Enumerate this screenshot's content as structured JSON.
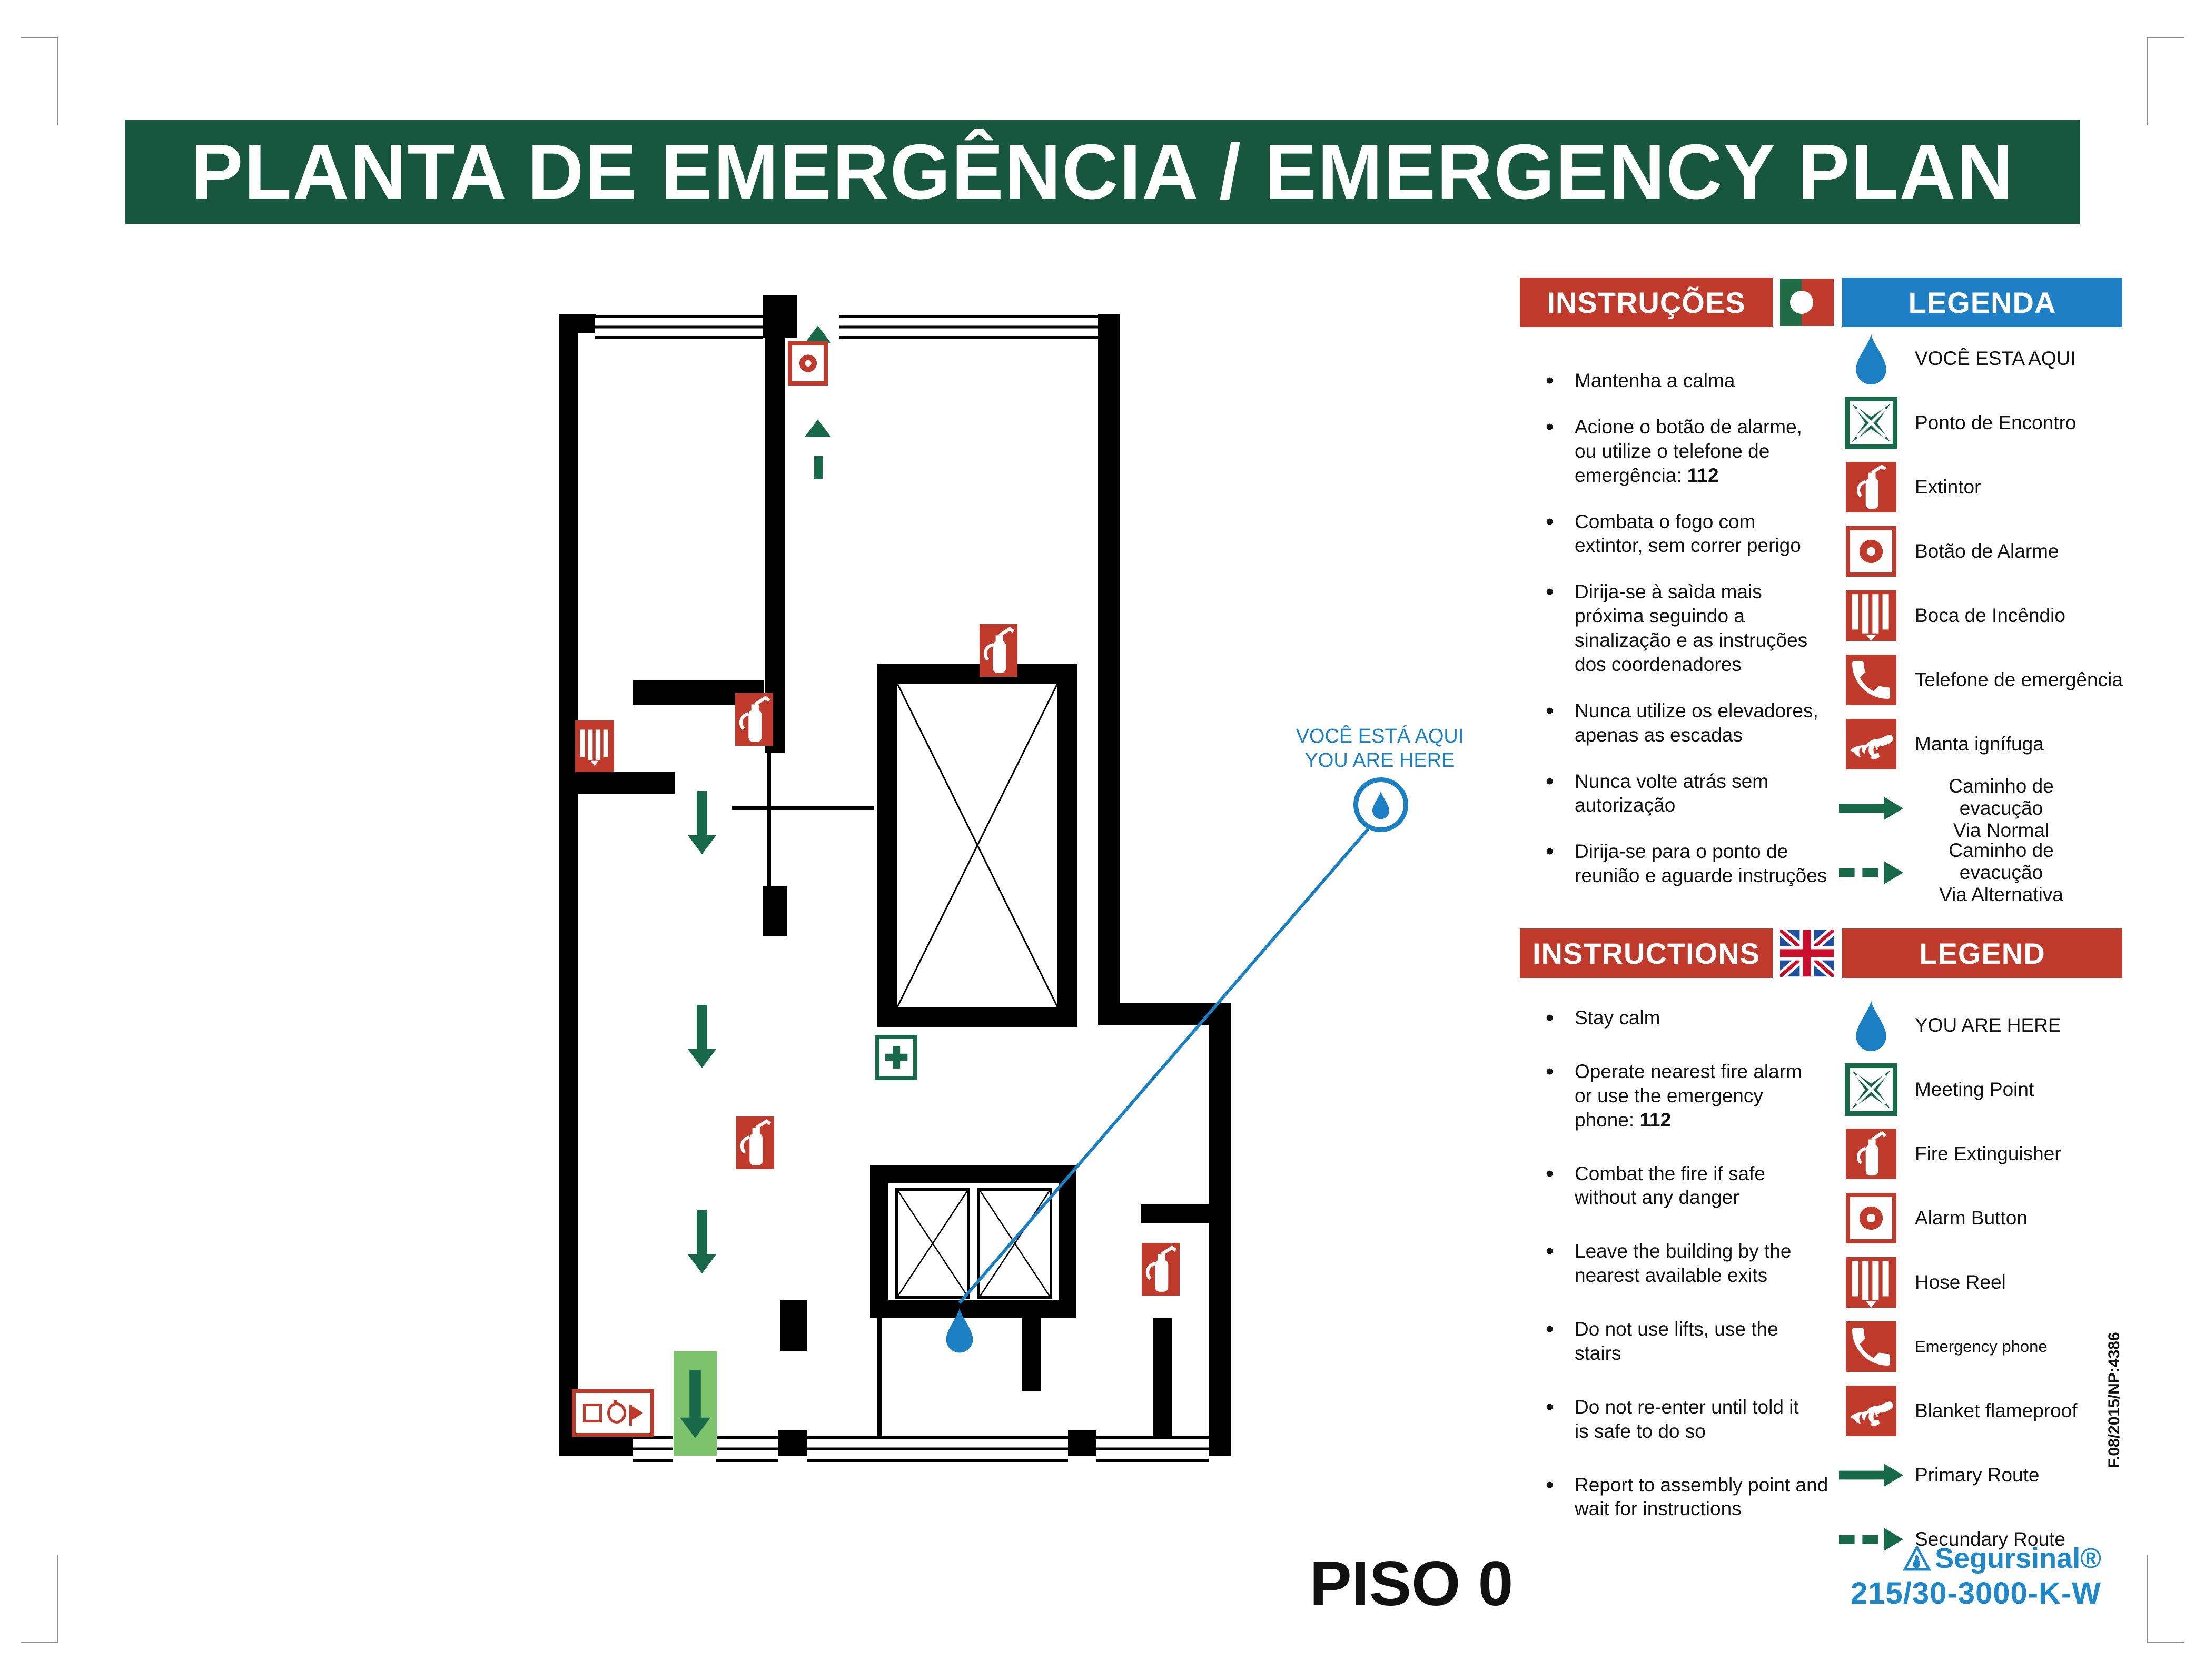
{
  "title": "PLANTA DE EMERGÊNCIA / EMERGENCY PLAN",
  "floor_label": "PISO 0",
  "callout": {
    "line1": "VOCÊ ESTÁ AQUI",
    "line2": "YOU ARE HERE"
  },
  "pt": {
    "instructions_header": "INSTRUÇÕES",
    "legend_header": "LEGENDA",
    "instructions": [
      "Mantenha a calma",
      "Acione o botão de alarme,\nou utilize o telefone de\nemergência: 112",
      "Combata o fogo com\nextintor, sem correr perigo",
      "Dirija-se à saìda mais\npróxima seguindo a\nsinalização e as instruções\ndos coordenadores",
      "Nunca utilize os elevadores,\napenas as escadas",
      "Nunca volte atrás sem\nautorização",
      "Dirija-se para o ponto de\nreunião e aguarde instruções"
    ],
    "legend": [
      {
        "icon": "you-are-here-drop-icon",
        "label": "VOCÊ ESTA AQUI"
      },
      {
        "icon": "meeting-point-icon",
        "label": "Ponto de Encontro"
      },
      {
        "icon": "fire-extinguisher-icon",
        "label": "Extintor"
      },
      {
        "icon": "alarm-button-icon",
        "label": "Botão de Alarme"
      },
      {
        "icon": "hose-reel-icon",
        "label": "Boca de Incêndio"
      },
      {
        "icon": "emergency-phone-icon",
        "label": "Telefone de emergência"
      },
      {
        "icon": "fire-blanket-icon",
        "label": "Manta ignífuga"
      },
      {
        "icon": "primary-route-arrow-icon",
        "label": "Caminho de evacução\nVia Normal"
      },
      {
        "icon": "secondary-route-arrow-icon",
        "label": "Caminho de evacução\nVia Alternativa"
      }
    ]
  },
  "en": {
    "instructions_header": "INSTRUCTIONS",
    "legend_header": "LEGEND",
    "instructions": [
      "Stay calm",
      "Operate nearest fire alarm\nor use the emergency\nphone: 112",
      "Combat the fire if safe\nwithout any danger",
      "Leave the building by the\nnearest available exits",
      "Do not use lifts, use the\nstairs",
      "Do not re-enter until told it\nis safe to do so",
      "Report to assembly point and\nwait for instructions"
    ],
    "legend": [
      {
        "icon": "you-are-here-drop-icon",
        "label": "YOU ARE HERE"
      },
      {
        "icon": "meeting-point-icon",
        "label": "Meeting Point"
      },
      {
        "icon": "fire-extinguisher-icon",
        "label": "Fire Extinguisher"
      },
      {
        "icon": "alarm-button-icon",
        "label": "Alarm Button"
      },
      {
        "icon": "hose-reel-icon",
        "label": "Hose Reel"
      },
      {
        "icon": "emergency-phone-icon",
        "label": "Emergency phone"
      },
      {
        "icon": "fire-blanket-icon",
        "label": "Blanket flameproof"
      },
      {
        "icon": "primary-route-arrow-icon",
        "label": "Primary Route"
      },
      {
        "icon": "secondary-route-arrow-icon",
        "label": "Secundary Route"
      }
    ]
  },
  "footer": {
    "doc_ref": "F.08/2015/NP:4386",
    "brand": "Segursinal®",
    "model": "215/30-3000-K-W"
  },
  "colors": {
    "title_green": "#17573F",
    "signal_red": "#C03A2B",
    "legend_blue": "#1F7FC4",
    "marker_blue": "#1B7FC4",
    "route_green": "#17694A",
    "exit_green": "#7CC36B"
  }
}
